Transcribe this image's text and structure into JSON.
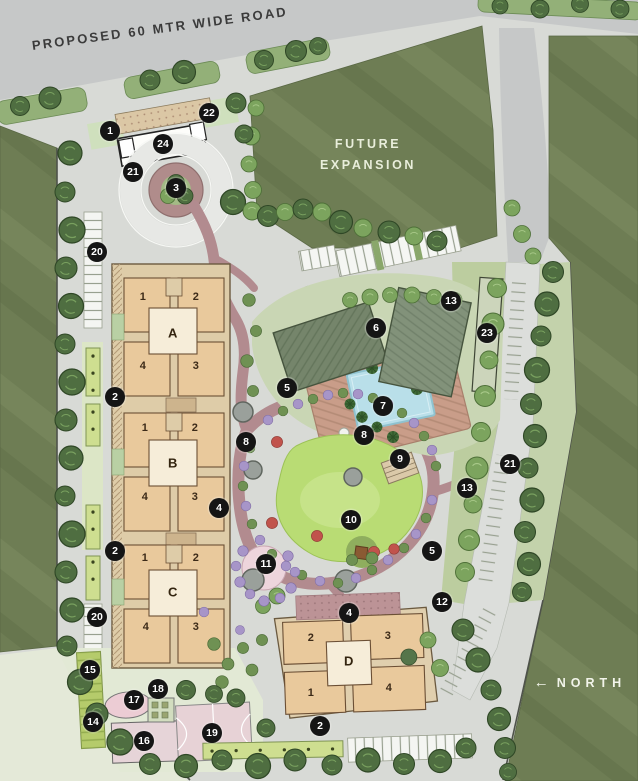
{
  "title": "Residential Site Master Plan",
  "labels": {
    "road": "PROPOSED 60 MTR WIDE ROAD",
    "future_expansion": "FUTURE\nEXPANSION",
    "north": "NORTH",
    "north_arrow": "←"
  },
  "buildings": {
    "towers": [
      {
        "name": "A",
        "units": [
          "1",
          "2",
          "4",
          "3"
        ]
      },
      {
        "name": "B",
        "units": [
          "1",
          "2",
          "4",
          "3"
        ]
      },
      {
        "name": "C",
        "units": [
          "1",
          "2",
          "4",
          "3"
        ]
      },
      {
        "name": "D",
        "units": [
          "2",
          "3",
          "1",
          "4"
        ]
      }
    ]
  },
  "markers": [
    {
      "n": "1"
    },
    {
      "n": "22"
    },
    {
      "n": "24"
    },
    {
      "n": "21"
    },
    {
      "n": "3"
    },
    {
      "n": "20"
    },
    {
      "n": "2"
    },
    {
      "n": "8"
    },
    {
      "n": "4"
    },
    {
      "n": "2"
    },
    {
      "n": "20"
    },
    {
      "n": "15"
    },
    {
      "n": "17"
    },
    {
      "n": "18"
    },
    {
      "n": "14"
    },
    {
      "n": "16"
    },
    {
      "n": "19"
    },
    {
      "n": "2"
    },
    {
      "n": "4"
    },
    {
      "n": "12"
    },
    {
      "n": "5"
    },
    {
      "n": "10"
    },
    {
      "n": "11"
    },
    {
      "n": "9"
    },
    {
      "n": "8"
    },
    {
      "n": "7"
    },
    {
      "n": "5"
    },
    {
      "n": "6"
    },
    {
      "n": "13"
    },
    {
      "n": "23"
    },
    {
      "n": "13"
    },
    {
      "n": "21"
    }
  ]
}
